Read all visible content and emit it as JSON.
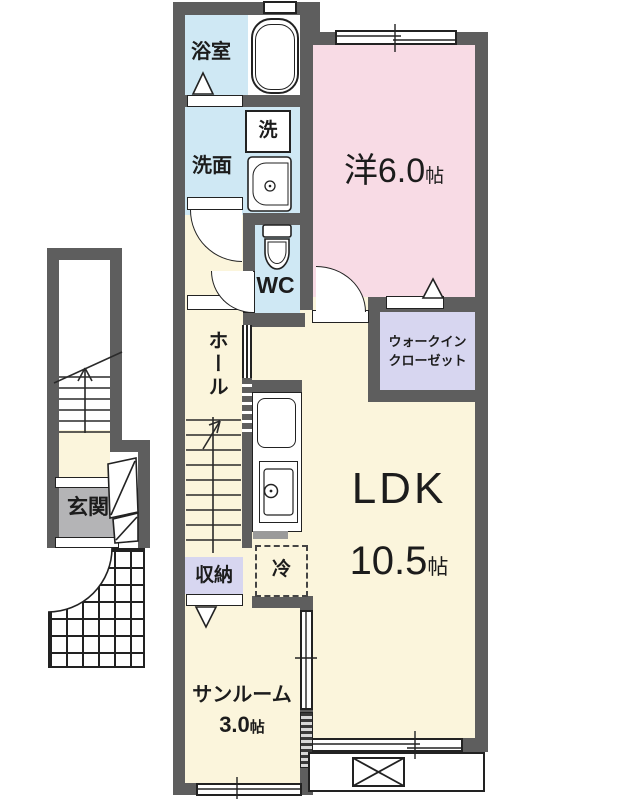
{
  "rooms": {
    "bathroom": {
      "label": "浴室"
    },
    "washer_box": {
      "label": "洗"
    },
    "washroom": {
      "label": "洗面"
    },
    "wc": {
      "label": "WC"
    },
    "western_room": {
      "label": "洋6.0",
      "unit": "帖"
    },
    "wic": {
      "line1": "ウォークイン",
      "line2": "クローゼット"
    },
    "hall": {
      "label": "ホール"
    },
    "genkan": {
      "label": "玄関"
    },
    "storage": {
      "label": "収納"
    },
    "refrigerator": {
      "label": "冷"
    },
    "ldk": {
      "label": "LDK",
      "size": "10.5",
      "unit": "帖"
    },
    "sunroom": {
      "label": "サンルーム",
      "size": "3.0",
      "unit": "帖"
    }
  },
  "colors": {
    "wall": "#5e5e5e",
    "water": "#cfe8f4",
    "bedroom": "#f8dbe5",
    "living": "#fbf5dc",
    "closet": "#d7d6f0",
    "entrance_floor": "#b4b4b6"
  }
}
